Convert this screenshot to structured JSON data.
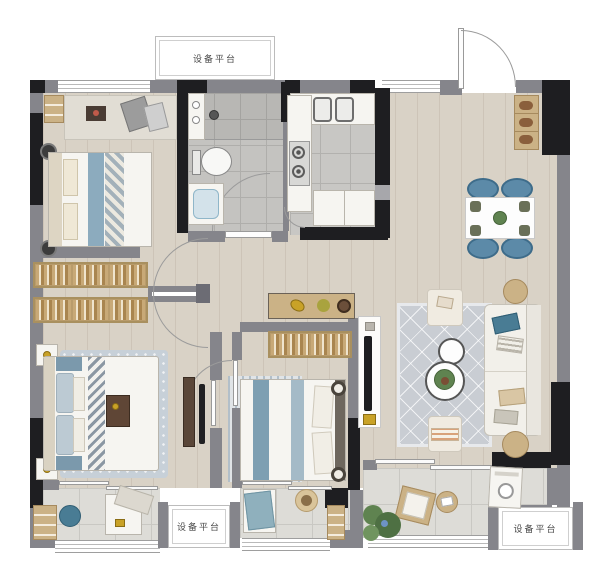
{
  "labels": {
    "platform_top": "设备平台",
    "platform_bottom_left": "设备平台",
    "platform_bottom_right": "设备平台"
  },
  "palette": {
    "wall_dark": "#1e1e21",
    "wall_gray": "#85858b",
    "floor_wood": "#d9d2c6",
    "tile_gray": "#c4c3c0",
    "balcony_tile": "#dddcd7",
    "accent_blue": "#5c8aa8",
    "accent_teal": "#497c94",
    "wood_tan": "#cbb286",
    "furniture_white": "#f6f5f1",
    "gold_accent": "#c9a227"
  }
}
